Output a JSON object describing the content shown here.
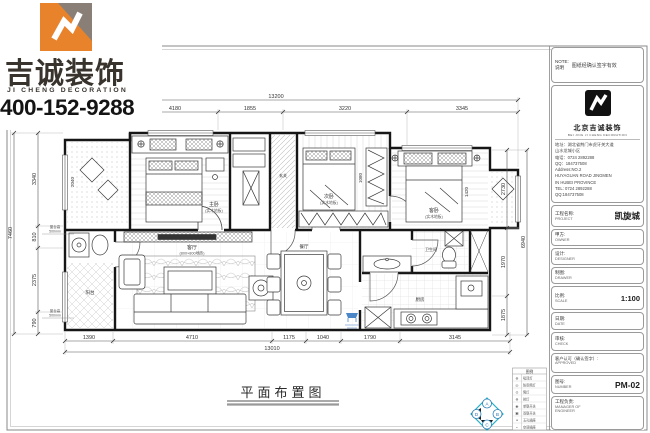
{
  "brand": {
    "company_cn": "吉诚装饰",
    "company_en": "JI CHENG DECORATION",
    "phone": "400-152-9288",
    "logo_icon": "jicheng-diamond-logo"
  },
  "plan": {
    "title": "平面布置图",
    "dims": {
      "top_overall": "13200",
      "top": [
        "4180",
        "1855",
        "3220",
        "3345"
      ],
      "bottom": [
        "1390",
        "4710",
        "1175",
        "1040",
        "1790",
        "3145"
      ],
      "bottom_overall": "13010",
      "left": [
        "3340",
        "810",
        "2375",
        "790"
      ],
      "left_overall": "7460",
      "right": [
        "2730",
        "1970",
        "1875"
      ],
      "right_overall": "6940",
      "inner": {
        "bath": "2040",
        "wardrobe": "1080",
        "bed": "1420"
      }
    },
    "sill": {
      "l1": "窗台高",
      "l2": "500mm"
    },
    "rooms": {
      "master": "主卧",
      "master_sub": "(实木地板)",
      "bed2": "次卧",
      "bed2_sub": "(实木地板)",
      "bed3": "客卧",
      "bed3_sub": "(实木地板)",
      "living": "客厅",
      "living_sub": "(800×800地砖)",
      "dining": "餐厅",
      "kitchen": "厨房",
      "bath": "卫生间",
      "balcony": "阳台",
      "entry": "玄关"
    }
  },
  "legend": {
    "title": "图例",
    "rows": [
      {
        "s": "⊕",
        "t": "吸顶灯"
      },
      {
        "s": "◎",
        "t": "防雾筒灯"
      },
      {
        "s": "⊙",
        "t": "筒灯"
      },
      {
        "s": "⊗",
        "t": "射灯"
      },
      {
        "s": "◉",
        "t": "单联开关"
      },
      {
        "s": "▣",
        "t": "双联开关"
      },
      {
        "s": "≡",
        "t": "五孔插座"
      },
      {
        "s": "⌁",
        "t": "空调插座"
      }
    ]
  },
  "compass": {
    "letters": [
      "A",
      "B",
      "C",
      "D"
    ],
    "icon": "elevation-compass-icon"
  },
  "title_block": {
    "note_en": "NOTE:",
    "note_cn": "说明",
    "note_text": "图纸经确认签字有效",
    "company_cn": "北京吉诚装饰",
    "company_en": "BEI JING JI CHENG DECORATION",
    "addr1": "地址：湖北省荆门市虎牙关大道",
    "addr2": "山水龙城小区",
    "tel": "电话：0724 2892288",
    "qq": "QQ：184737508",
    "addr_en1": "Address:NO.2",
    "addr_en2": "HUYAGUAN ROAD JINGMEN",
    "addr_en3": "IN HUBEI PROVINCE",
    "tel_en": "TEL: 0724 2892288",
    "qq_en": "QQ:184737508",
    "rows": [
      {
        "cn": "工程名称:",
        "en": "PROJECT",
        "value": "凯旋城"
      },
      {
        "cn": "甲方:",
        "en": "OWNER",
        "value": ""
      },
      {
        "cn": "设计:",
        "en": "DESIGNER",
        "value": ""
      },
      {
        "cn": "制图:",
        "en": "DRAWER",
        "value": ""
      },
      {
        "cn": "比例:",
        "en": "SCALE",
        "value": "1:100"
      },
      {
        "cn": "日期:",
        "en": "DATE",
        "value": ""
      },
      {
        "cn": "审核:",
        "en": "CHECK",
        "value": ""
      },
      {
        "cn": "客户认可（确认签字）:",
        "en": "APPROVED",
        "value": ""
      },
      {
        "cn": "图号:",
        "en": "NUMBER",
        "value": "PM-02"
      },
      {
        "cn": "工程负责:",
        "en": "MANAGER OF ENGINEER",
        "value": ""
      }
    ]
  }
}
